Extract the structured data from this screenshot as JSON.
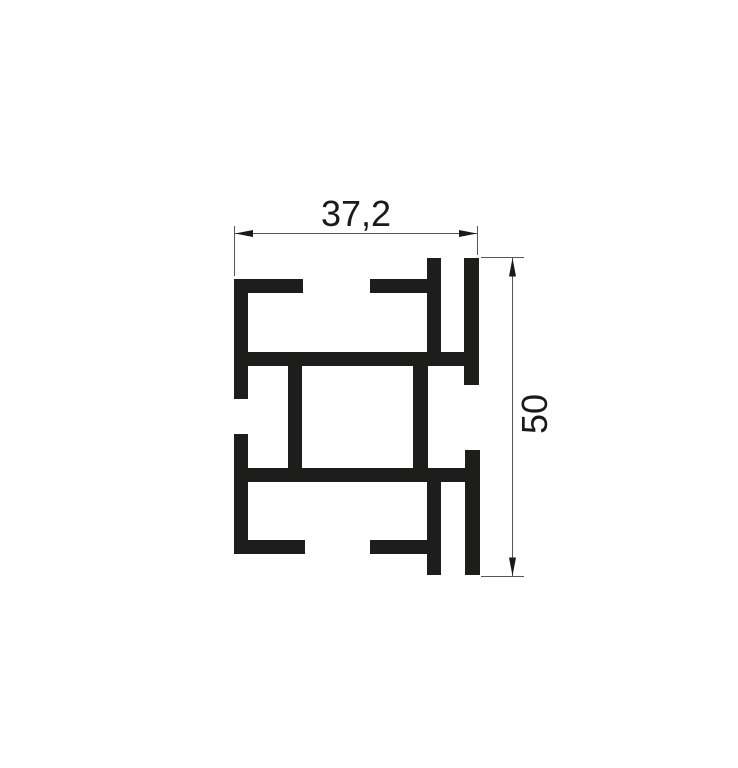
{
  "drawing": {
    "description": "Aluminium profile cross-section technical drawing",
    "background": "#ffffff",
    "profile_color": "#1d1d1b",
    "dim_line_color": "#575757",
    "arrow_color": "#1a1a1a",
    "profile_bars": [
      {
        "name": "top-left-flange",
        "x": 234,
        "y": 279,
        "w": 69,
        "h": 14
      },
      {
        "name": "left-wall-upper",
        "x": 234,
        "y": 279,
        "w": 14,
        "h": 120
      },
      {
        "name": "top-inner-flange",
        "x": 370,
        "y": 279,
        "w": 71,
        "h": 14
      },
      {
        "name": "inner-wall-upper",
        "x": 427,
        "y": 258,
        "w": 14,
        "h": 108
      },
      {
        "name": "right-wall-upper",
        "x": 464,
        "y": 258,
        "w": 15,
        "h": 127
      },
      {
        "name": "upper-web",
        "x": 234,
        "y": 352,
        "w": 245,
        "h": 14
      },
      {
        "name": "box-wall-left",
        "x": 288,
        "y": 352,
        "w": 14,
        "h": 130
      },
      {
        "name": "box-wall-right",
        "x": 413,
        "y": 352,
        "w": 15,
        "h": 130
      },
      {
        "name": "lower-web",
        "x": 234,
        "y": 468,
        "w": 246,
        "h": 14
      },
      {
        "name": "left-wall-lower",
        "x": 234,
        "y": 434,
        "w": 14,
        "h": 120
      },
      {
        "name": "bottom-left-flange",
        "x": 234,
        "y": 540,
        "w": 71,
        "h": 14
      },
      {
        "name": "bottom-inner-flange",
        "x": 370,
        "y": 540,
        "w": 71,
        "h": 14
      },
      {
        "name": "inner-wall-lower",
        "x": 427,
        "y": 468,
        "w": 14,
        "h": 107
      },
      {
        "name": "right-wall-lower",
        "x": 465,
        "y": 450,
        "w": 15,
        "h": 125
      }
    ],
    "dimensions": {
      "width": {
        "label": "37,2",
        "dim_line": {
          "x1": 235,
          "y1": 233.5,
          "x2": 477,
          "y2": 233.5
        },
        "ext_lines": [
          {
            "x1": 234.5,
            "y1": 226,
            "x2": 234.5,
            "y2": 276
          },
          {
            "x1": 477.5,
            "y1": 226,
            "x2": 477.5,
            "y2": 255
          }
        ],
        "arrows": [
          "235,233.5 253,230 253,237",
          "477,233.5 459,230 459,237"
        ]
      },
      "height": {
        "label": "50",
        "dim_line": {
          "x1": 512.5,
          "y1": 258,
          "x2": 512.5,
          "y2": 576
        },
        "ext_lines": [
          {
            "x1": 481,
            "y1": 257.5,
            "x2": 524,
            "y2": 257.5
          },
          {
            "x1": 481,
            "y1": 576.5,
            "x2": 524,
            "y2": 576.5
          }
        ],
        "arrows": [
          "512.5,258 509,276.5 516,276.5",
          "512.5,576 509,557.5 516,557.5"
        ]
      }
    }
  }
}
